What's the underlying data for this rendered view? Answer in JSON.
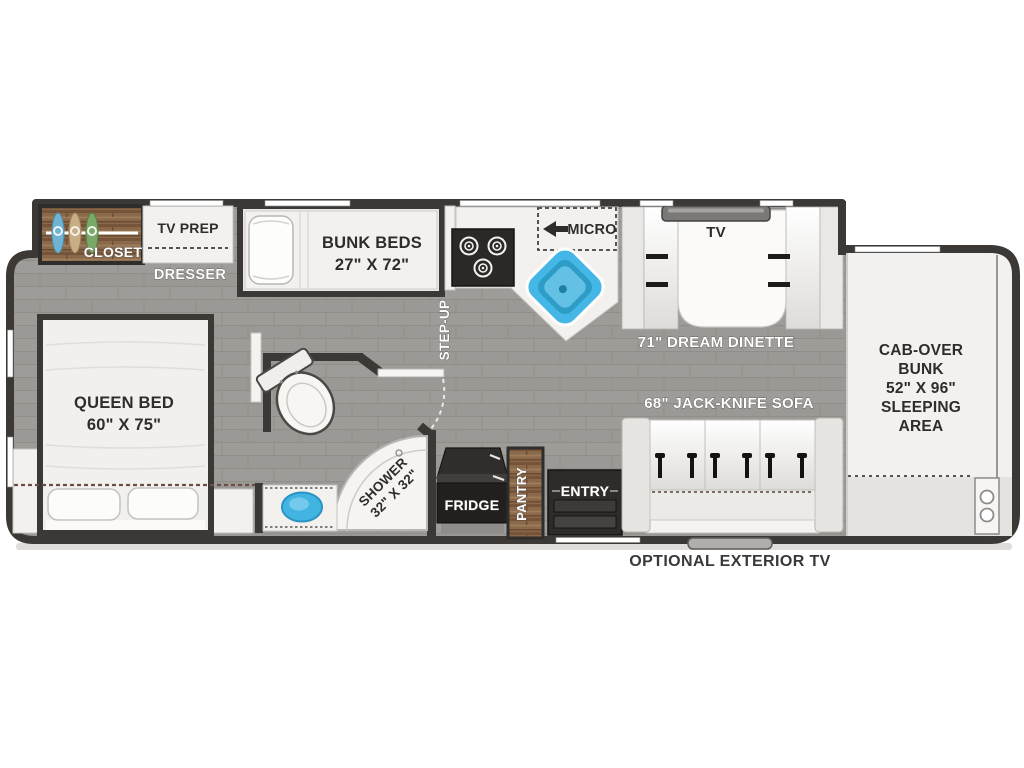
{
  "labels": {
    "closet": "CLOSET",
    "tv_prep": "TV PREP",
    "dresser": "DRESSER",
    "bunk_beds": "BUNK BEDS",
    "bunk_beds_size": "27\" X 72\"",
    "step_up": "STEP-UP",
    "micro": "MICRO",
    "tv": "TV",
    "dream_dinette": "71\" DREAM DINETTE",
    "cab_over_bunk": [
      "CAB-OVER",
      "BUNK",
      "52\" X 96\"",
      "SLEEPING",
      "AREA"
    ],
    "queen_bed": "QUEEN BED",
    "queen_bed_size": "60\" X 75\"",
    "shower": "SHOWER",
    "shower_size": "32\" X 32\"",
    "fridge": "FRIDGE",
    "pantry": "PANTRY",
    "entry": "ENTRY",
    "jack_knife_sofa": "68\" JACK-KNIFE SOFA",
    "optional_exterior_tv": "OPTIONAL EXTERIOR TV"
  },
  "colors": {
    "wall": "#3b3835",
    "floor": "#9b9995",
    "counter_white": "#f2f1ee",
    "wood_brown": "#8a684a",
    "appliance_dark": "#262422",
    "sink_blue": "#45b7e6",
    "bench_gray": "#d7d6d2",
    "label_white": "#ffffff",
    "label_dark": "#2e2d2b"
  }
}
